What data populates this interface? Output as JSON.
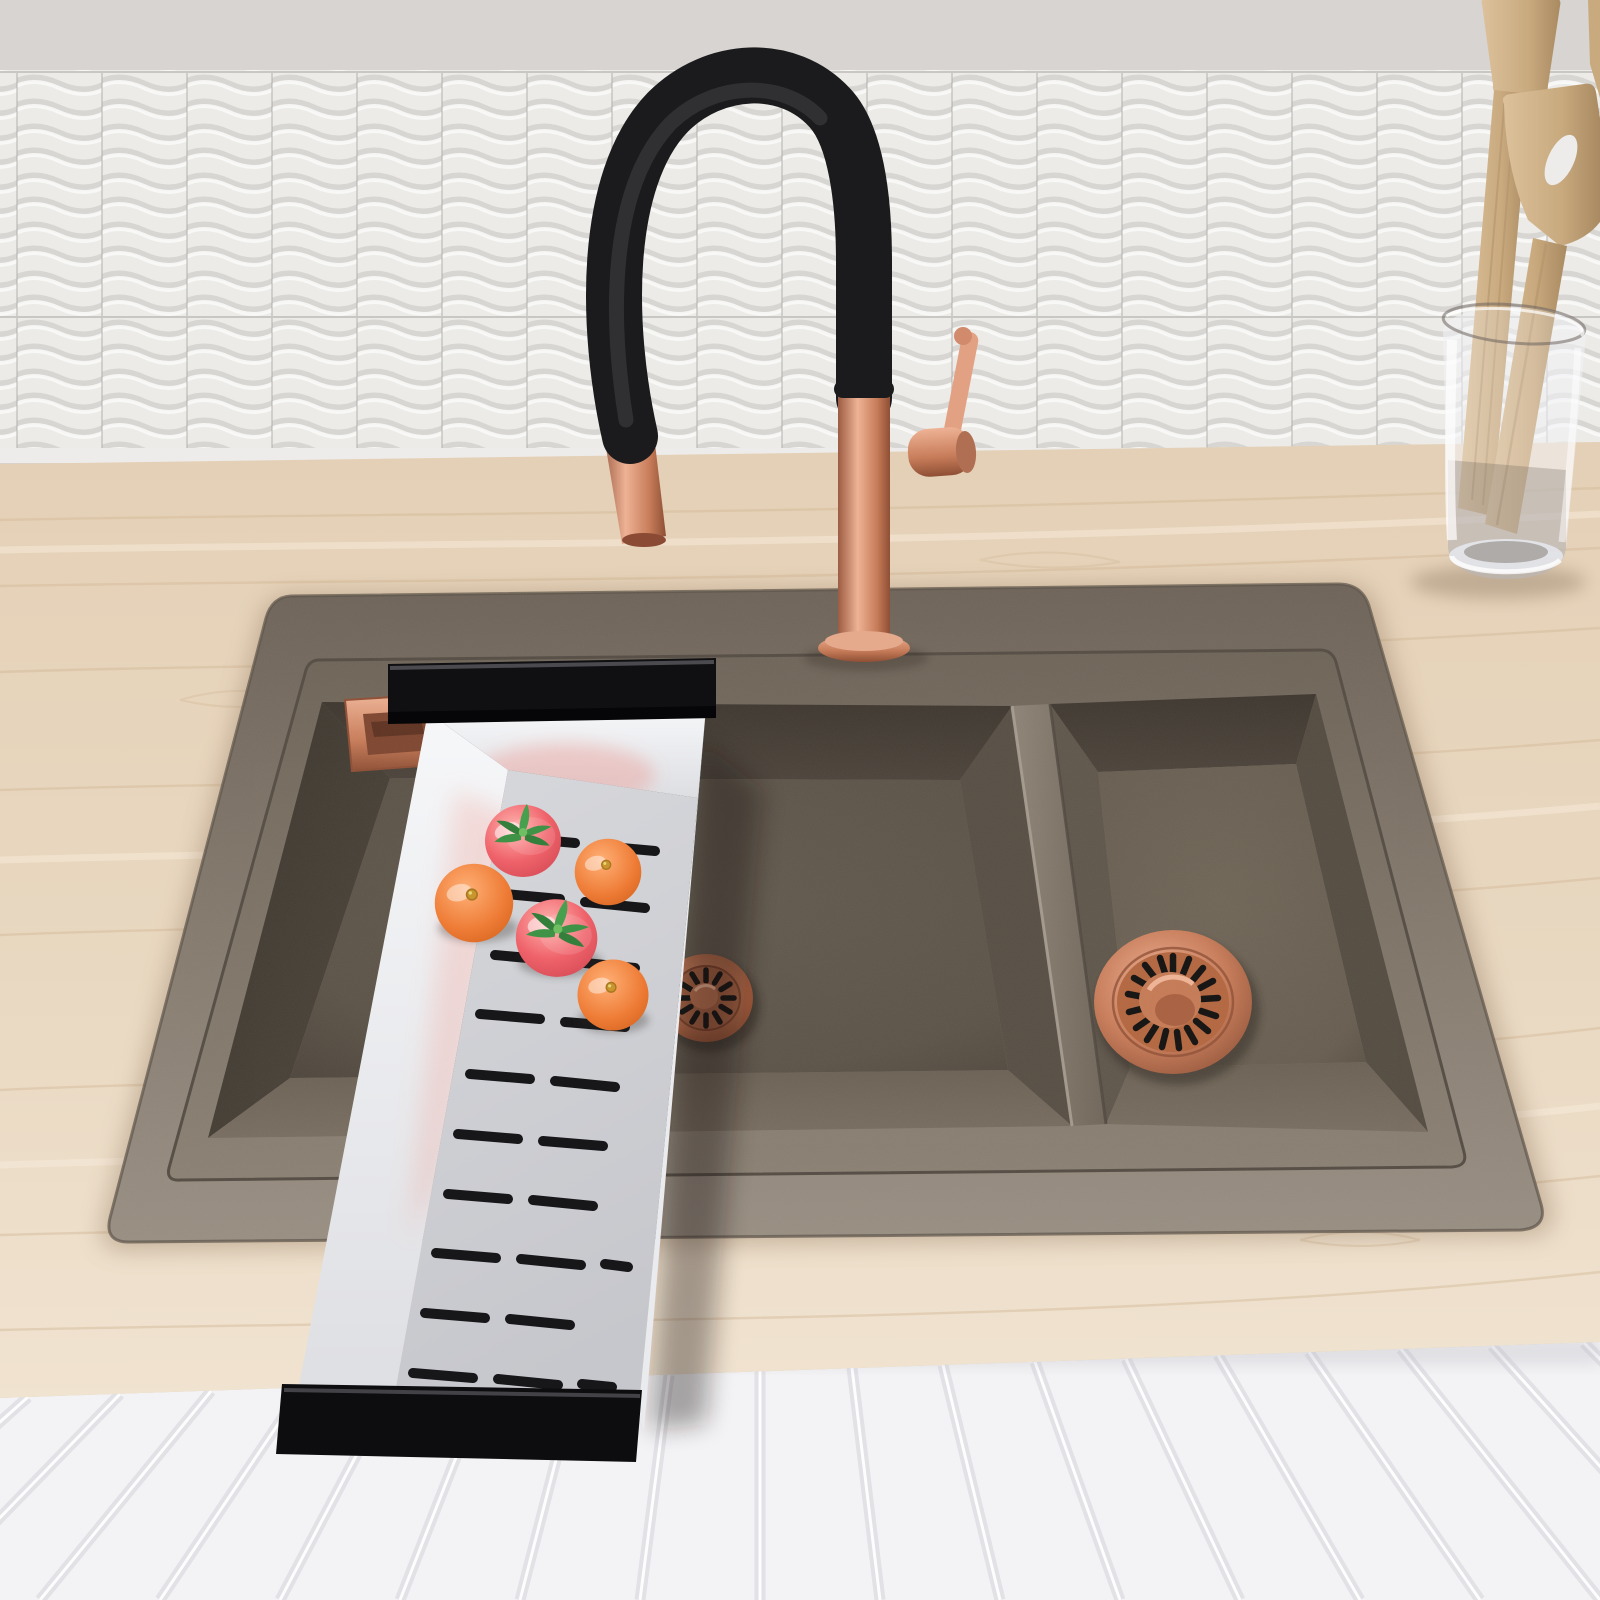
{
  "scene": {
    "type": "3d-product-render",
    "description": "Top-front view of a taupe granite composite double-bowl drop-in kitchen sink set into a light maple countertop, with a matte black and brushed copper pull-down gooseneck faucet, a stainless steel over-sink colander holding two tomatoes and three oranges, copper basket-strainer drains in both bowls, a copper rectangular overflow vent, a white 3D wavy tile backsplash, and a white fluted cabinet front below the counter. A glass utensil holder with wooden spatulas stands on the counter at the right.",
    "objects": [
      {
        "name": "backsplash",
        "material": "white 3D wave ceramic tile"
      },
      {
        "name": "countertop",
        "material": "light maple wood"
      },
      {
        "name": "sink",
        "material": "taupe granite composite",
        "bowls": 2
      },
      {
        "name": "faucet",
        "material": "matte black + brushed copper",
        "style": "pull-down gooseneck"
      },
      {
        "name": "colander",
        "material": "stainless steel",
        "handles": "black"
      },
      {
        "name": "drain-strainers",
        "material": "copper",
        "count": 2
      },
      {
        "name": "overflow-vent",
        "material": "copper"
      },
      {
        "name": "utensil-holder",
        "material": "clear glass",
        "contents": "wooden utensils"
      },
      {
        "name": "cabinet",
        "material": "white fluted panel"
      }
    ],
    "counts": {
      "tomatoes": 2,
      "oranges": 3,
      "bowls": 2,
      "drains": 2,
      "wooden_utensils": 3
    }
  },
  "palette": {
    "wall": "#d8d4d1",
    "tile_base": "#f2f1ef",
    "tile_shadow": "#d9d6d3",
    "tile_highlight": "#ffffff",
    "grout": "#a9a6a3",
    "trim": "#edeceb",
    "wood_light": "#f0e3d0",
    "wood_mid": "#e4d0b6",
    "wood_grain": "#d3b896",
    "wood_edge": "#d2ba9e",
    "cabinet": "#f3f3f5",
    "flute_shadow": "#e1e1e6",
    "flute_highlight": "#fdfdfe",
    "deck_light": "#988e82",
    "deck_dark": "#6e6358",
    "shelf_light": "#8a8073",
    "shelf_dark": "#6e6458",
    "bowl_darkest": "#3e372f",
    "bowl_dark": "#4c443b",
    "bowl_mid": "#5c5348",
    "bowl_floor_right": "#675d50",
    "bowl_light": "#786d60",
    "divider_light": "#8d8376",
    "divider_dark": "#6f6559",
    "copper": "#c77c59",
    "copper_dark": "#8e4f35",
    "copper_deep": "#7c4129",
    "copper_light": "#eeb295",
    "copper_pale": "#e5a98c",
    "black": "#1b1b1d",
    "black_sheen": "#454549",
    "tray_white": "#f6f7f9",
    "tray_wall": "#e7e8ea",
    "tray_floor": "#d7d8dc",
    "tray_floor_dark": "#c6c7cc",
    "slot": "#17171a",
    "tomato_light": "#ffb2ae",
    "tomato": "#ef626a",
    "tomato_dark": "#d14752",
    "stem": "#3f9346",
    "stem_light": "#6fbe62",
    "orange_light": "#ffb077",
    "orange": "#ee7c36",
    "orange_dark": "#d2611d",
    "glass_edge": "#6b635c",
    "utensil_light": "#dcc19b",
    "utensil_mid": "#c9aa7f",
    "utensil_dark": "#a98a61"
  }
}
